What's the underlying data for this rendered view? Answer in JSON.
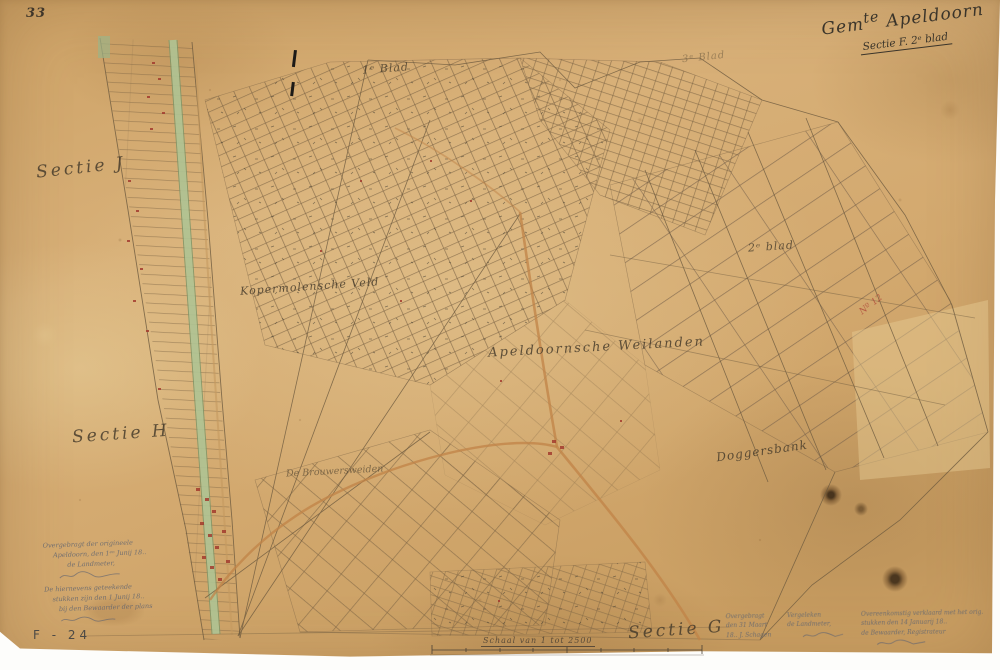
{
  "sheet": {
    "page_number": "33",
    "archive_code": "F - 24",
    "title_gem": "Gem",
    "title_gem_sup": "te",
    "title_name": "Apeldoorn",
    "subtitle": "Sectie F. 2ᵉ blad"
  },
  "labels": {
    "sectie_j": "Sectie J",
    "sectie_h": "Sectie H",
    "sectie_g": "Sectie G",
    "blad_1": "1ᵉ Blad",
    "blad_2": "2ᵉ blad",
    "blad_3": "3ᵉ Blad",
    "kopermolensche_veld": "Kopermolensche Veld",
    "apeldoornsche_weilanden": "Apeldoornsche Weilanden",
    "doggersbank": "Doggersbank",
    "de_brouwersweiden": "De Brouwersweiden",
    "red_annotation": "Nº 12"
  },
  "scale": {
    "caption": "Schaal van 1 tot 2500"
  },
  "notes": {
    "bottom_left": [
      "Overgebragt der origineele",
      "Apeldoorn, den 1ᵉⁿ Junij 18..",
      "de Landmeter,",
      "De hiernevens geteekende",
      "stukken zijn den 1 Junij 18..",
      "bij den Bewaarder der plans"
    ],
    "bottom_right_col1": [
      "Overgebragt",
      "den 31 Maart",
      "18.. J. Schagen"
    ],
    "bottom_right_col2": [
      "Vergeleken",
      "de Landmeter,"
    ],
    "bottom_right_col3": [
      "Overeenkomstig verklaard met het orig.",
      "stukken den 14 Januarij 18..",
      "de Bewaarder, Registrateur"
    ]
  },
  "colors": {
    "paper": "#d3a96f",
    "ink": "#473c2c",
    "parcel_line": "#7a6243",
    "road": "#c08347",
    "canal": "#aec394",
    "building_red": "#a33b2e"
  }
}
